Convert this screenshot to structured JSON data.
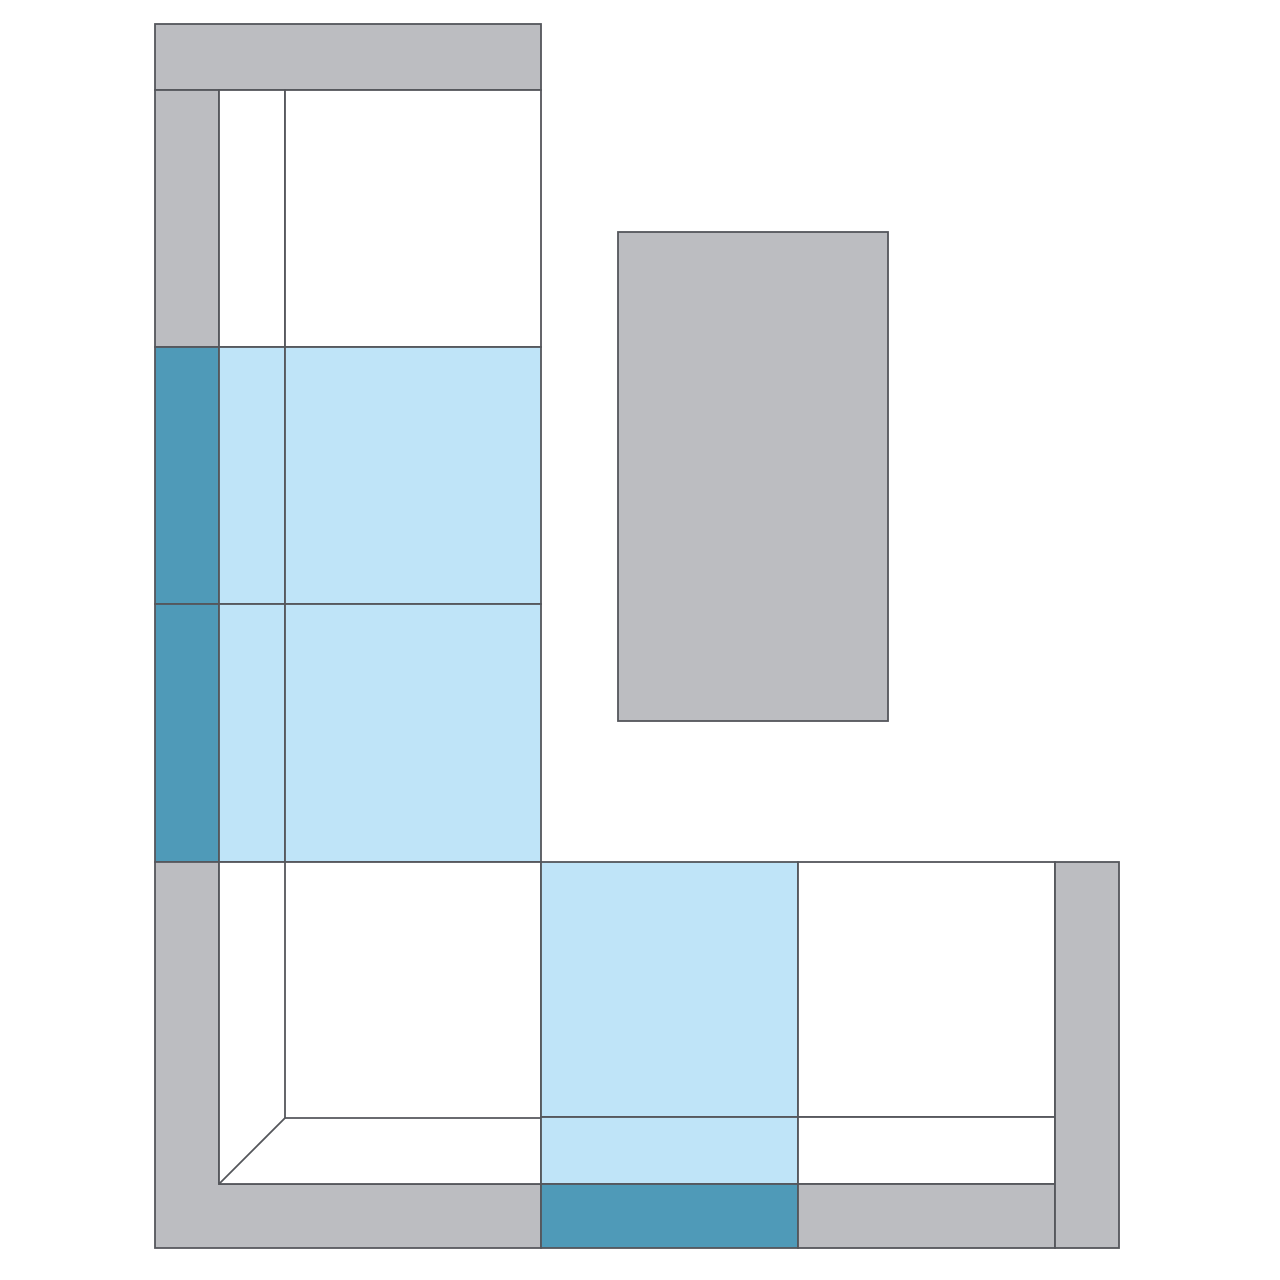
{
  "canvas": {
    "width": 1280,
    "height": 1280,
    "background": "#ffffff"
  },
  "palette": {
    "frame_gray": "#bcbdc1",
    "seat_white": "#ffffff",
    "selected_seat_blue": "#bfe4f8",
    "selected_back_teal": "#4f9ab8",
    "line": "#54565b"
  },
  "stroke": {
    "color_key": "line",
    "width": 1.8
  },
  "diagram": {
    "kind": "sectional-sofa-floor-plan",
    "shapes": [
      {
        "name": "top-armrest",
        "kind": "rect",
        "x": 155,
        "y": 24,
        "w": 386,
        "h": 66,
        "fill": "frame_gray",
        "interactable": false
      },
      {
        "name": "module-a1-backrest",
        "kind": "rect",
        "x": 155,
        "y": 90,
        "w": 64,
        "h": 257,
        "fill": "frame_gray",
        "interactable": true
      },
      {
        "name": "module-a1-seat-edge",
        "kind": "rect",
        "x": 219,
        "y": 90,
        "w": 66,
        "h": 257,
        "fill": "seat_white",
        "interactable": true
      },
      {
        "name": "module-a1-seat",
        "kind": "rect",
        "x": 285,
        "y": 90,
        "w": 256,
        "h": 257,
        "fill": "seat_white",
        "interactable": true
      },
      {
        "name": "module-a2-backrest-selected",
        "kind": "rect",
        "x": 155,
        "y": 347,
        "w": 64,
        "h": 257,
        "fill": "selected_back_teal",
        "interactable": true
      },
      {
        "name": "module-a2-seat-edge-selected",
        "kind": "rect",
        "x": 219,
        "y": 347,
        "w": 66,
        "h": 257,
        "fill": "selected_seat_blue",
        "interactable": true
      },
      {
        "name": "module-a2-seat-selected",
        "kind": "rect",
        "x": 285,
        "y": 347,
        "w": 256,
        "h": 257,
        "fill": "selected_seat_blue",
        "interactable": true
      },
      {
        "name": "module-a3-backrest-selected",
        "kind": "rect",
        "x": 155,
        "y": 604,
        "w": 64,
        "h": 258,
        "fill": "selected_back_teal",
        "interactable": true
      },
      {
        "name": "module-a3-seat-edge-selected",
        "kind": "rect",
        "x": 219,
        "y": 604,
        "w": 66,
        "h": 258,
        "fill": "selected_seat_blue",
        "interactable": true
      },
      {
        "name": "module-a3-seat-selected",
        "kind": "rect",
        "x": 285,
        "y": 604,
        "w": 256,
        "h": 258,
        "fill": "selected_seat_blue",
        "interactable": true
      },
      {
        "name": "corner-frame",
        "kind": "polygon",
        "points": [
          [
            155,
            862
          ],
          [
            219,
            862
          ],
          [
            219,
            1184
          ],
          [
            541,
            1184
          ],
          [
            541,
            1248
          ],
          [
            155,
            1248
          ]
        ],
        "fill": "frame_gray",
        "interactable": false
      },
      {
        "name": "corner-seat",
        "kind": "rect",
        "x": 219,
        "y": 862,
        "w": 322,
        "h": 322,
        "fill": "seat_white",
        "interactable": true
      },
      {
        "name": "corner-seat-edge-vertical",
        "kind": "line",
        "x1": 285,
        "y1": 862,
        "x2": 285,
        "y2": 1118,
        "interactable": false
      },
      {
        "name": "corner-seat-edge-horizontal",
        "kind": "line",
        "x1": 285,
        "y1": 1118,
        "x2": 541,
        "y2": 1118,
        "interactable": false
      },
      {
        "name": "corner-seat-miter-diagonal",
        "kind": "line",
        "x1": 219,
        "y1": 1184,
        "x2": 285,
        "y2": 1118,
        "interactable": false
      },
      {
        "name": "module-b1-seat-selected",
        "kind": "rect",
        "x": 541,
        "y": 862,
        "w": 257,
        "h": 255,
        "fill": "selected_seat_blue",
        "interactable": true
      },
      {
        "name": "module-b1-seat-edge-selected",
        "kind": "rect",
        "x": 541,
        "y": 1117,
        "w": 257,
        "h": 67,
        "fill": "selected_seat_blue",
        "interactable": true
      },
      {
        "name": "module-b1-backrest-selected",
        "kind": "rect",
        "x": 541,
        "y": 1184,
        "w": 257,
        "h": 64,
        "fill": "selected_back_teal",
        "interactable": true
      },
      {
        "name": "module-b2-seat",
        "kind": "rect",
        "x": 798,
        "y": 862,
        "w": 257,
        "h": 255,
        "fill": "seat_white",
        "interactable": true
      },
      {
        "name": "module-b2-seat-edge",
        "kind": "rect",
        "x": 798,
        "y": 1117,
        "w": 257,
        "h": 67,
        "fill": "seat_white",
        "interactable": true
      },
      {
        "name": "module-b2-backrest",
        "kind": "rect",
        "x": 798,
        "y": 1184,
        "w": 257,
        "h": 64,
        "fill": "frame_gray",
        "interactable": true
      },
      {
        "name": "right-armrest",
        "kind": "rect",
        "x": 1055,
        "y": 862,
        "w": 64,
        "h": 386,
        "fill": "frame_gray",
        "interactable": false
      },
      {
        "name": "ottoman",
        "kind": "rect",
        "x": 618,
        "y": 232,
        "w": 270,
        "h": 489,
        "fill": "frame_gray",
        "interactable": true
      }
    ]
  }
}
